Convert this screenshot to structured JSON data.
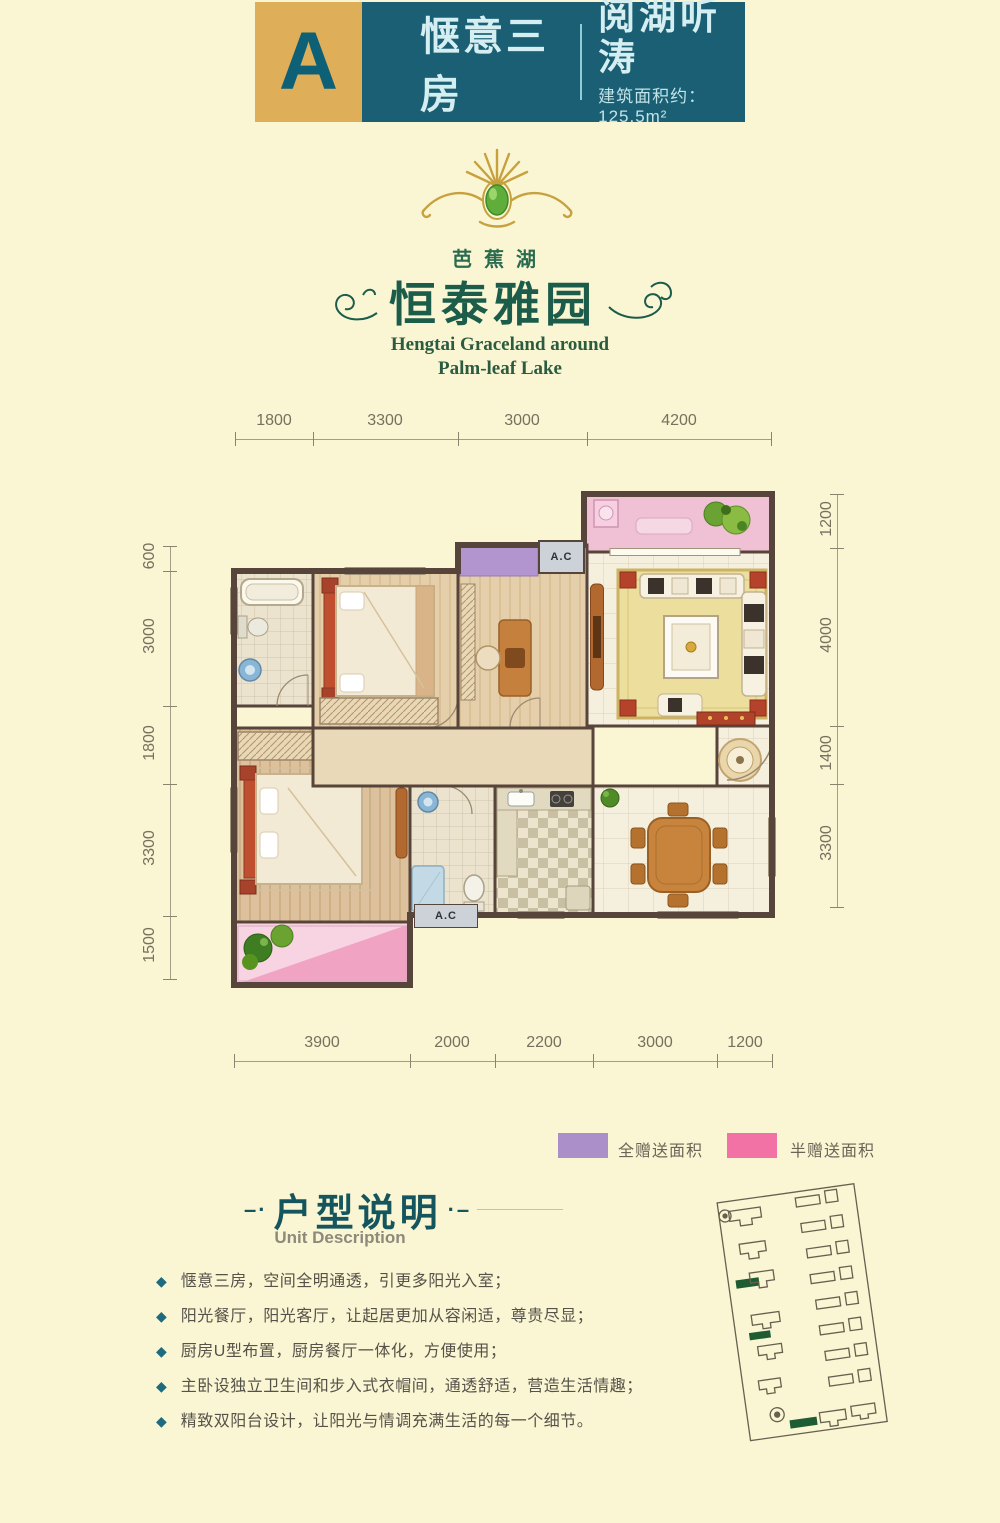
{
  "header": {
    "unit_letter": "A",
    "unit_type": "惬意三房",
    "tagline": "阅湖听涛",
    "area": "建筑面积约：125.5m²"
  },
  "logo": {
    "lake_name": "芭蕉湖",
    "brand_name": "恒泰雅园",
    "english_line1": "Hengtai Graceland around",
    "english_line2": "Palm-leaf Lake"
  },
  "floorplan": {
    "dimensions_top": [
      "1800",
      "3300",
      "3000",
      "4200"
    ],
    "dimensions_bottom": [
      "3900",
      "2000",
      "2200",
      "3000",
      "1200"
    ],
    "dimensions_left": [
      "600",
      "3000",
      "1800",
      "3300",
      "1500"
    ],
    "dimensions_right": [
      "1200",
      "4000",
      "1400",
      "3300"
    ],
    "ac_label_top": "A.C",
    "ac_label_bottom": "A.C"
  },
  "legend": {
    "full_gift_label": "全赠送面积",
    "full_gift_color": "#ab8fc9",
    "half_gift_label": "半赠送面积",
    "half_gift_color": "#f272a6"
  },
  "description": {
    "title": "户型说明",
    "subtitle": "Unit Description",
    "bullets": [
      "惬意三房，空间全明通透，引更多阳光入室；",
      "阳光餐厅，阳光客厅，让起居更加从容闲适，尊贵尽显；",
      "厨房U型布置，厨房餐厅一体化，方便使用；",
      "主卧设独立卫生间和步入式衣帽间，通透舒适，营造生活情趣；",
      "精致双阳台设计，让阳光与情调充满生活的每一个细节。"
    ]
  },
  "icons": {
    "bullet_diamond": "◆"
  },
  "colors": {
    "accent_teal": "#1a5f73",
    "accent_gold": "#dfae58",
    "background": "#faf5d3",
    "wall": "#57443a"
  }
}
